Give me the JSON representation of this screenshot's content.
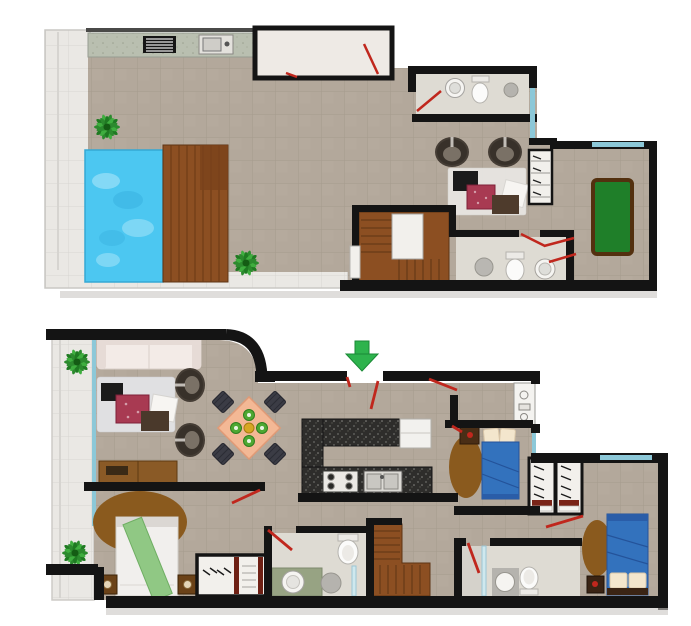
{
  "figure": {
    "label": "Two-storey apartment floor plan, top-down architectural rendering",
    "floor_count": 2,
    "visible_text": "none"
  },
  "palette": {
    "background": "#ffffff",
    "wall": "#141414",
    "tile_floor": "#b3a89b",
    "tile_line": "#a2978a",
    "terrace_tile": "#eae8e4",
    "bath_floor": "#dedbd3",
    "window_teal": "#8cc8d8",
    "door_swing_red": "#c0271d",
    "entrance_green": "#2eb34d",
    "pool_blue": "#4cc7f1",
    "deck_wood": "#8c4f22",
    "plant_green": "#2c8a2e",
    "game_table_green": "#1f7f29",
    "bed_blue": "#3372bd",
    "blanket_green": "#90c884",
    "rug_brown": "#8a5a1e",
    "sofa_cream": "#f3ebe7",
    "dining_peach": "#f3b895",
    "granite_dark": "#2e2d2b",
    "console_brown": "#8a5a26",
    "armchair_dark": "#453d35",
    "crimson_table": "#a83a52"
  },
  "floors": [
    {
      "label": "Upper floor - roof terrace level",
      "rooms": [
        {
          "name": "terrace",
          "items": [
            "potted-plant",
            "potted-plant",
            "outdoor-counter",
            "grill",
            "counter-sink",
            "swimming-pool",
            "wood-deck"
          ]
        },
        {
          "name": "storage-room",
          "items": [
            "door-swing"
          ]
        },
        {
          "name": "bathroom-upper",
          "items": [
            "round-sink",
            "toilet",
            "shower-drain",
            "door-swing"
          ]
        },
        {
          "name": "lounge",
          "items": [
            "armchair",
            "armchair",
            "area-rug",
            "coffee-table-black",
            "coffee-table-crimson",
            "side-table-white",
            "ottoman-brown",
            "shelf-closet"
          ]
        },
        {
          "name": "games-room",
          "items": [
            "billiard-table",
            "window",
            "door-swing",
            "door-swing"
          ]
        },
        {
          "name": "staircase-upper",
          "items": [
            "landing",
            "door-gap"
          ]
        },
        {
          "name": "bathroom-lower",
          "items": [
            "toilet",
            "round-sink",
            "shower-drain",
            "door-swing"
          ]
        }
      ]
    },
    {
      "label": "Main floor - entrance level",
      "entrance_marker": "green-arrow-down",
      "rooms": [
        {
          "name": "balcony",
          "items": [
            "potted-plant",
            "potted-plant",
            "window-band"
          ]
        },
        {
          "name": "living-room",
          "items": [
            "sofa",
            "area-rug",
            "coffee-table-black",
            "coffee-table-crimson",
            "side-table-white",
            "ottoman-brown",
            "armchair",
            "armchair",
            "console-sideboard"
          ]
        },
        {
          "name": "dining-area",
          "items": [
            "square-table-diagonal",
            "dining-chair",
            "dining-chair",
            "dining-chair",
            "dining-chair",
            "green-place-setting-x4",
            "centerpiece"
          ]
        },
        {
          "name": "kitchen",
          "items": [
            "u-shaped-granite-counter",
            "cooktop-4-burner",
            "double-sink",
            "refrigerator"
          ]
        },
        {
          "name": "master-bedroom",
          "items": [
            "double-bed",
            "green-throw",
            "oval-rug",
            "nightstand",
            "nightstand",
            "wardrobe-hangers"
          ]
        },
        {
          "name": "master-bathroom",
          "items": [
            "round-sink",
            "green-vanity",
            "shower-glass",
            "toilet",
            "door-swing"
          ]
        },
        {
          "name": "staircase-lower",
          "items": []
        },
        {
          "name": "bedroom-2",
          "items": [
            "single-bed-blue",
            "pillows",
            "oval-rug",
            "nightstand",
            "laundry-closet"
          ]
        },
        {
          "name": "bathroom-2",
          "items": [
            "shower",
            "round-sink",
            "toilet",
            "door-swing"
          ]
        },
        {
          "name": "closet-1",
          "items": [
            "hanging-rail"
          ]
        },
        {
          "name": "closet-2",
          "items": [
            "hanging-rail"
          ]
        },
        {
          "name": "bedroom-3",
          "items": [
            "single-bed-blue",
            "pillows",
            "oval-rug",
            "nightstand",
            "window",
            "door-swing"
          ]
        }
      ]
    }
  ]
}
